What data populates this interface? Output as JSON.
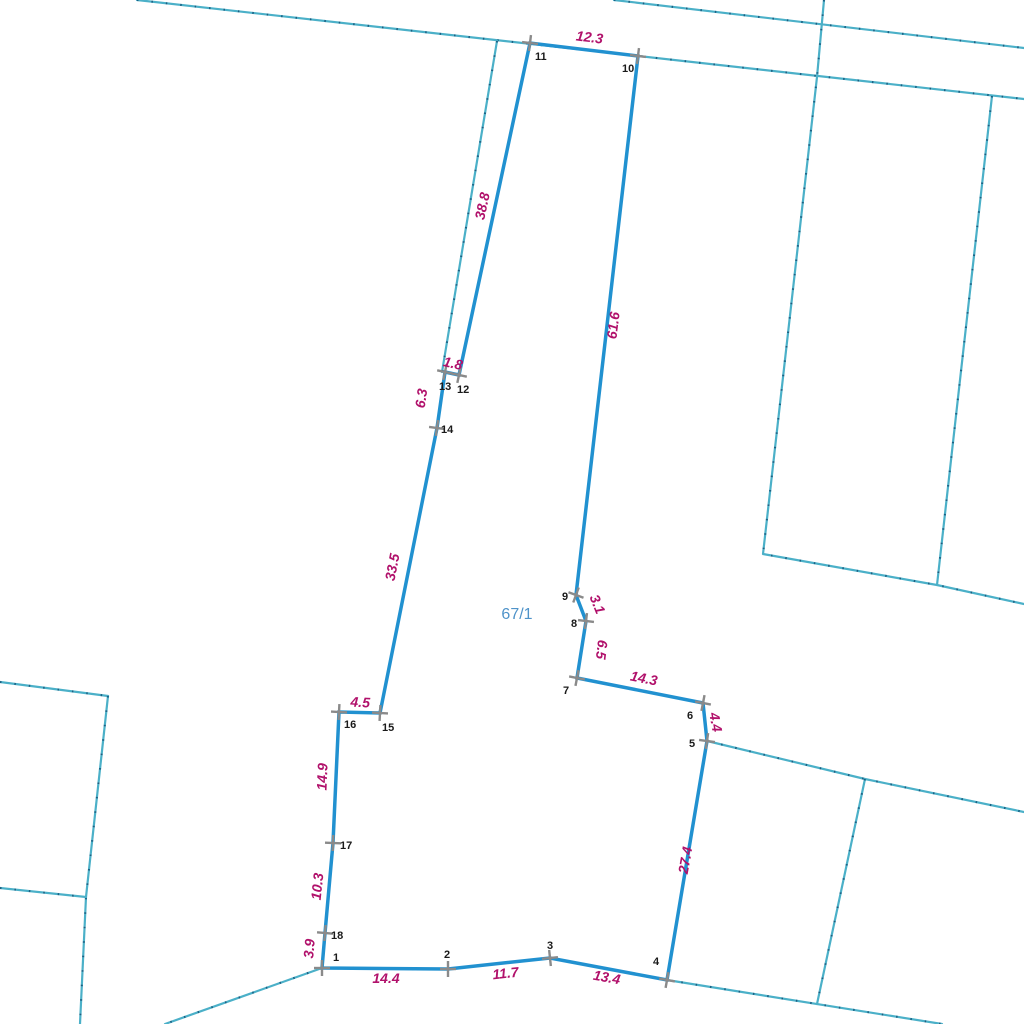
{
  "map": {
    "colors": {
      "parcel_stroke": "#2191d0",
      "neighbor_stroke": "#4bb0c8",
      "neighbor_speck": "#1c5f82",
      "measurement_text": "#b1116b",
      "vertex_number_text": "#1a1a1a",
      "parcel_label_text": "#4f93c9",
      "tick": "#8a8a8a",
      "background": "#ffffff"
    },
    "parcel": {
      "label": "67/1",
      "label_x": 517,
      "label_y": 619,
      "vertices": [
        {
          "id": "1",
          "x": 322,
          "y": 968,
          "num_x": 333,
          "num_y": 961,
          "tick_angle": 0
        },
        {
          "id": "2",
          "x": 448,
          "y": 969,
          "num_x": 444,
          "num_y": 958,
          "tick_angle": 0
        },
        {
          "id": "3",
          "x": 550,
          "y": 958,
          "num_x": 547,
          "num_y": 949,
          "tick_angle": -6
        },
        {
          "id": "4",
          "x": 667,
          "y": 980,
          "num_x": 653,
          "num_y": 965,
          "tick_angle": 10
        },
        {
          "id": "5",
          "x": 707,
          "y": 741,
          "num_x": 689,
          "num_y": 747,
          "tick_angle": 8
        },
        {
          "id": "6",
          "x": 703,
          "y": 703,
          "num_x": 687,
          "num_y": 719,
          "tick_angle": 11
        },
        {
          "id": "7",
          "x": 577,
          "y": 678,
          "num_x": 563,
          "num_y": 694,
          "tick_angle": 11
        },
        {
          "id": "8",
          "x": 586,
          "y": 621,
          "num_x": 571,
          "num_y": 627,
          "tick_angle": 7
        },
        {
          "id": "9",
          "x": 576,
          "y": 595,
          "num_x": 562,
          "num_y": 600,
          "tick_angle": 20
        },
        {
          "id": "10",
          "x": 638,
          "y": 56,
          "num_x": 622,
          "num_y": 72,
          "tick_angle": 7
        },
        {
          "id": "11",
          "x": 530,
          "y": 43,
          "num_x": 535,
          "num_y": 60,
          "tick_angle": 7
        },
        {
          "id": "12",
          "x": 459,
          "y": 375,
          "num_x": 457,
          "num_y": 393,
          "tick_angle": 12
        },
        {
          "id": "13",
          "x": 445,
          "y": 372,
          "num_x": 439,
          "num_y": 390,
          "tick_angle": 12
        },
        {
          "id": "14",
          "x": 437,
          "y": 428,
          "num_x": 441,
          "num_y": 433,
          "tick_angle": 8
        },
        {
          "id": "15",
          "x": 380,
          "y": 713,
          "num_x": 382,
          "num_y": 731,
          "tick_angle": 3
        },
        {
          "id": "16",
          "x": 339,
          "y": 712,
          "num_x": 344,
          "num_y": 728,
          "tick_angle": 3
        },
        {
          "id": "17",
          "x": 333,
          "y": 843,
          "num_x": 340,
          "num_y": 849,
          "tick_angle": 2
        },
        {
          "id": "18",
          "x": 325,
          "y": 933,
          "num_x": 331,
          "num_y": 939,
          "tick_angle": 5
        }
      ],
      "edges": [
        {
          "from": "1",
          "to": "2",
          "length": "14.4",
          "lx": 386,
          "ly": 983,
          "rot": 0
        },
        {
          "from": "2",
          "to": "3",
          "length": "11.7",
          "lx": 506,
          "ly": 978,
          "rot": -6
        },
        {
          "from": "3",
          "to": "4",
          "length": "13.4",
          "lx": 606,
          "ly": 982,
          "rot": 10
        },
        {
          "from": "4",
          "to": "5",
          "length": "27.4",
          "lx": 690,
          "ly": 861,
          "rot": -80
        },
        {
          "from": "5",
          "to": "6",
          "length": "4.4",
          "lx": 711,
          "ly": 723,
          "rot": 80
        },
        {
          "from": "6",
          "to": "7",
          "length": "14.3",
          "lx": 643,
          "ly": 683,
          "rot": 11
        },
        {
          "from": "7",
          "to": "8",
          "length": "6.5",
          "lx": 597,
          "ly": 649,
          "rot": 97
        },
        {
          "from": "8",
          "to": "9",
          "length": "3.1",
          "lx": 593,
          "ly": 606,
          "rot": 68
        },
        {
          "from": "9",
          "to": "10",
          "length": "61.6",
          "lx": 618,
          "ly": 326,
          "rot": -83
        },
        {
          "from": "10",
          "to": "11",
          "length": "12.3",
          "lx": 589,
          "ly": 42,
          "rot": 7
        },
        {
          "from": "11",
          "to": "12",
          "length": "38.8",
          "lx": 487,
          "ly": 207,
          "rot": -78
        },
        {
          "from": "12",
          "to": "13",
          "length": "1.8",
          "lx": 452,
          "ly": 368,
          "rot": 12
        },
        {
          "from": "13",
          "to": "14",
          "length": "6.3",
          "lx": 426,
          "ly": 399,
          "rot": -82
        },
        {
          "from": "14",
          "to": "15",
          "length": "33.5",
          "lx": 397,
          "ly": 568,
          "rot": -79
        },
        {
          "from": "15",
          "to": "16",
          "length": "4.5",
          "lx": 360,
          "ly": 707,
          "rot": 3
        },
        {
          "from": "16",
          "to": "17",
          "length": "14.9",
          "lx": 327,
          "ly": 777,
          "rot": -88
        },
        {
          "from": "17",
          "to": "18",
          "length": "10.3",
          "lx": 322,
          "ly": 887,
          "rot": -84
        },
        {
          "from": "18",
          "to": "1",
          "length": "3.9",
          "lx": 314,
          "ly": 949,
          "rot": -85
        }
      ]
    },
    "neighbor_boundaries": [
      {
        "name": "road-north-edge",
        "points": [
          [
            137,
            0
          ],
          [
            1024,
            99
          ]
        ]
      },
      {
        "name": "upper-right-line",
        "points": [
          [
            614,
            0
          ],
          [
            1024,
            48
          ]
        ]
      },
      {
        "name": "right-block-west-side",
        "points": [
          [
            824,
            0
          ],
          [
            817,
            77
          ],
          [
            763,
            554
          ],
          [
            937,
            585
          ],
          [
            1024,
            604
          ]
        ]
      },
      {
        "name": "right-block-east-side",
        "points": [
          [
            992,
            96
          ],
          [
            960,
            380
          ],
          [
            937,
            585
          ]
        ]
      },
      {
        "name": "left-strip-line",
        "points": [
          [
            497,
            41
          ],
          [
            442,
            372
          ]
        ]
      },
      {
        "name": "southeast-upper-line",
        "points": [
          [
            707,
            741
          ],
          [
            865,
            779
          ],
          [
            1024,
            812
          ]
        ]
      },
      {
        "name": "southeast-cross-line",
        "points": [
          [
            865,
            779
          ],
          [
            817,
            1004
          ]
        ]
      },
      {
        "name": "south-line-from-4",
        "points": [
          [
            667,
            980
          ],
          [
            942,
            1024
          ]
        ]
      },
      {
        "name": "southwest-line-from-1",
        "points": [
          [
            322,
            968
          ],
          [
            165,
            1024
          ]
        ]
      },
      {
        "name": "west-parcel-top",
        "points": [
          [
            0,
            682
          ],
          [
            108,
            696
          ]
        ]
      },
      {
        "name": "west-parcel-side",
        "points": [
          [
            108,
            696
          ],
          [
            86,
            897
          ],
          [
            80,
            1024
          ]
        ]
      },
      {
        "name": "west-parcel-branch",
        "points": [
          [
            0,
            888
          ],
          [
            86,
            897
          ]
        ]
      }
    ]
  }
}
